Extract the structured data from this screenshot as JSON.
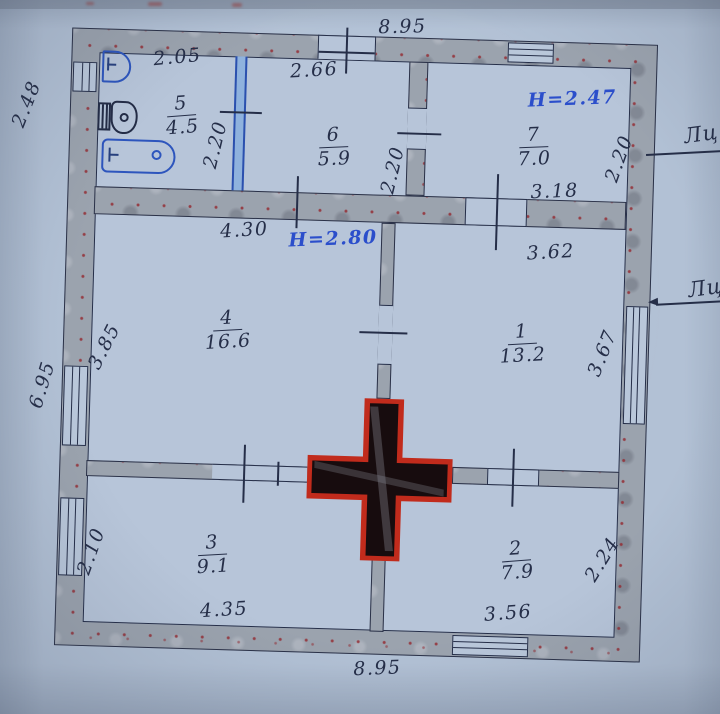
{
  "rooms": [
    {
      "num": "5",
      "area": "4.5"
    },
    {
      "num": "6",
      "area": "5.9"
    },
    {
      "num": "7",
      "area": "7.0"
    },
    {
      "num": "4",
      "area": "16.6"
    },
    {
      "num": "1",
      "area": "13.2"
    },
    {
      "num": "3",
      "area": "9.1"
    },
    {
      "num": "2",
      "area": "7.9"
    }
  ],
  "dimensions": {
    "top_width": "8.95",
    "bottom_width": "8.95",
    "left_upper": "2.48",
    "left_side": "6.95",
    "r5_width": "2.05",
    "r5_depth": "2.20",
    "r6_width": "2.66",
    "r6_depth": "2.20",
    "r7_width": "3.18",
    "r7_depth": "2.20",
    "r4_width": "4.30",
    "r4_depth": "3.85",
    "r1_width": "3.62",
    "r1_depth": "3.67",
    "r3_width": "4.35",
    "r3_depth": "2.10",
    "r2_width": "3.56",
    "r2_depth": "2.24"
  },
  "heights": {
    "attic_rooms": "H=2.47",
    "main_rooms": "H=2.80"
  },
  "edge_labels": {
    "upper": "Лц",
    "lower": "Лц"
  },
  "icons": {
    "stove": "stove-cross-icon (red outlined cross, dark fill)",
    "sink": "sink-icon (blue D-shape basin)",
    "toilet": "toilet-icon (tank + bowl)",
    "bathtub": "bathtub-icon (blue rounded tub)",
    "arrow": "arrow-left-icon"
  },
  "colors": {
    "paper": "#b2c1d5",
    "ink": "#252e48",
    "wall_fill": "#9ba3ae",
    "wall_speckle": "#942d34",
    "annotation_blue": "#2b4ecb",
    "fixture_blue": "#2d55bd",
    "partition_blue": "#8fb2dd",
    "stove_red": "#c12b1c",
    "stove_fill": "#170c0e"
  }
}
